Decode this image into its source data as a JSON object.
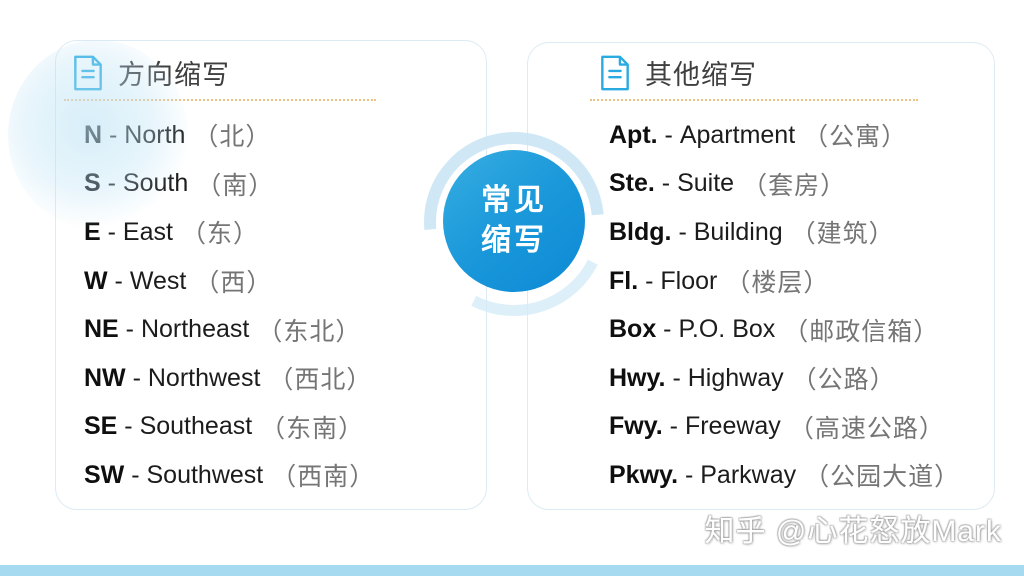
{
  "center_badge": {
    "line1": "常见",
    "line2": "缩写"
  },
  "list_separator": "-",
  "left_panel": {
    "title": "方向缩写",
    "icon": "document-icon",
    "items": [
      {
        "abbr": "N",
        "full": "North",
        "cn": "（北）"
      },
      {
        "abbr": "S",
        "full": "South",
        "cn": "（南）"
      },
      {
        "abbr": "E",
        "full": "East",
        "cn": "（东）"
      },
      {
        "abbr": "W",
        "full": "West",
        "cn": "（西）"
      },
      {
        "abbr": "NE",
        "full": "Northeast",
        "cn": "（东北）"
      },
      {
        "abbr": "NW",
        "full": "Northwest",
        "cn": "（西北）"
      },
      {
        "abbr": "SE",
        "full": "Southeast",
        "cn": "（东南）"
      },
      {
        "abbr": "SW",
        "full": "Southwest",
        "cn": "（西南）"
      }
    ]
  },
  "right_panel": {
    "title": "其他缩写",
    "icon": "document-icon",
    "items": [
      {
        "abbr": "Apt.",
        "full": "Apartment",
        "cn": "（公寓）"
      },
      {
        "abbr": "Ste.",
        "full": "Suite",
        "cn": "（套房）"
      },
      {
        "abbr": "Bldg.",
        "full": "Building",
        "cn": "（建筑）"
      },
      {
        "abbr": "Fl.",
        "full": "Floor",
        "cn": "（楼层）"
      },
      {
        "abbr": "Box",
        "full": "P.O. Box",
        "cn": "（邮政信箱）"
      },
      {
        "abbr": "Hwy.",
        "full": "Highway",
        "cn": "（公路）"
      },
      {
        "abbr": "Fwy.",
        "full": "Freeway",
        "cn": "（高速公路）"
      },
      {
        "abbr": "Pkwy.",
        "full": "Parkway",
        "cn": "（公园大道）"
      }
    ]
  },
  "watermark": "知乎 @心花怒放Mark",
  "colors": {
    "accent_blue": "#29abe2",
    "circle_gradient_top": "#38ade2",
    "circle_gradient_bottom": "#0d89d5",
    "dotted_divider": "#eec184",
    "bottom_strip": "#a6daf1",
    "card_border": "#dcebf3",
    "body_text": "#1c1c1c",
    "cn_text": "#757575"
  }
}
